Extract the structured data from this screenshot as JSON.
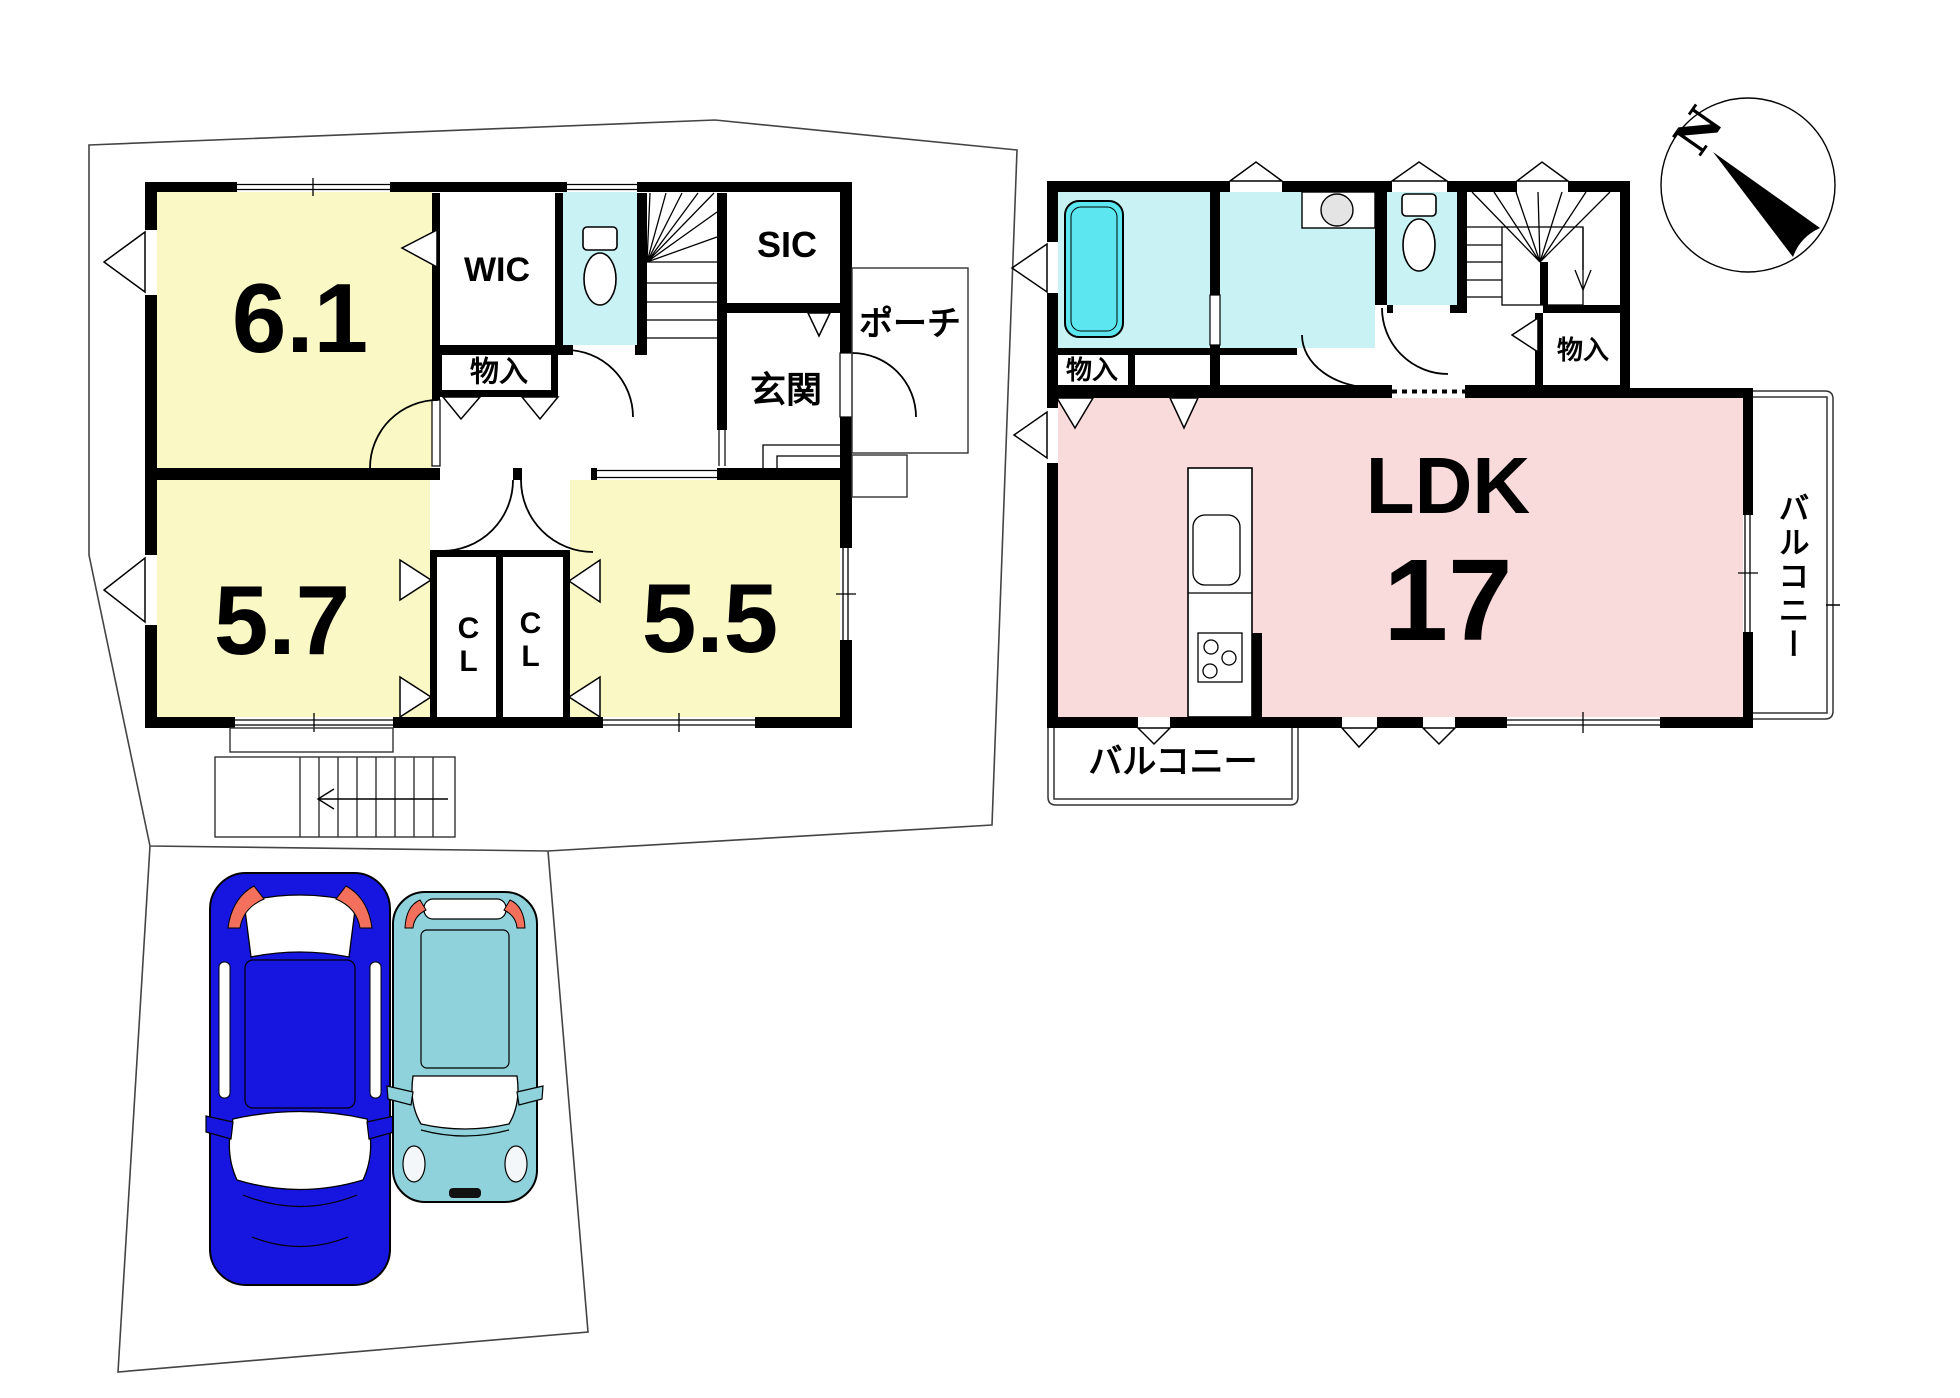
{
  "floor1": {
    "room_6_1": "6.1",
    "wic": "WIC",
    "storage": "物入",
    "sic": "SIC",
    "porch": "ポーチ",
    "entrance": "玄関",
    "room_5_7": "5.7",
    "closet_left": "CL",
    "closet_right": "CL",
    "room_5_5": "5.5"
  },
  "floor2": {
    "storage_left": "物入",
    "storage_right": "物入",
    "ldk": "LDK",
    "ldk_size": "17",
    "balcony_side": "バルコニー",
    "balcony_bottom": "バルコニー"
  },
  "compass": {
    "north": "N"
  },
  "colors": {
    "room_yellow": "#FAF8C5",
    "ldk_pink": "#FADBDB",
    "wet_cyan": "#C9F2F5",
    "tub_cyan": "#5CE6F0",
    "car_blue": "#1616E0",
    "car_teal": "#8FD2DB",
    "accent_red": "#F2705C"
  }
}
